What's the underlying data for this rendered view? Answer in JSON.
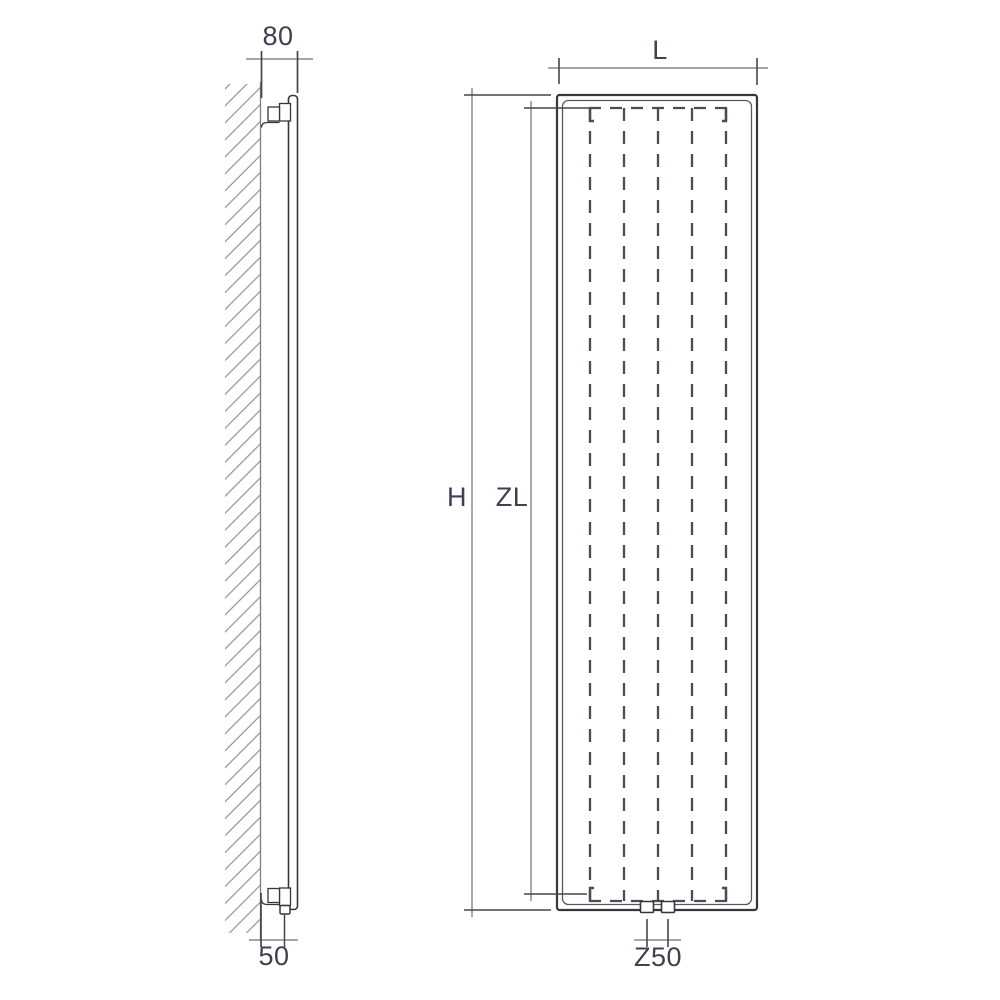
{
  "colors": {
    "background": "#ffffff",
    "line_object": "#35373c",
    "line_inner": "#55585e",
    "line_hidden": "#4a4d53",
    "line_dimension": "#6f7277",
    "line_extension": "#44464b",
    "line_wall": "#7a7d82",
    "line_hatch": "#8f9196",
    "text_color": "#3d4150"
  },
  "dimensions": {
    "depth_wall_to_front": {
      "label": "80"
    },
    "wall_to_pipe_offset": {
      "label": "50"
    },
    "width": {
      "label": "L"
    },
    "height": {
      "label": "H"
    },
    "element_height": {
      "label": "ZL"
    },
    "connection_spacing": {
      "label": "Z50"
    }
  }
}
